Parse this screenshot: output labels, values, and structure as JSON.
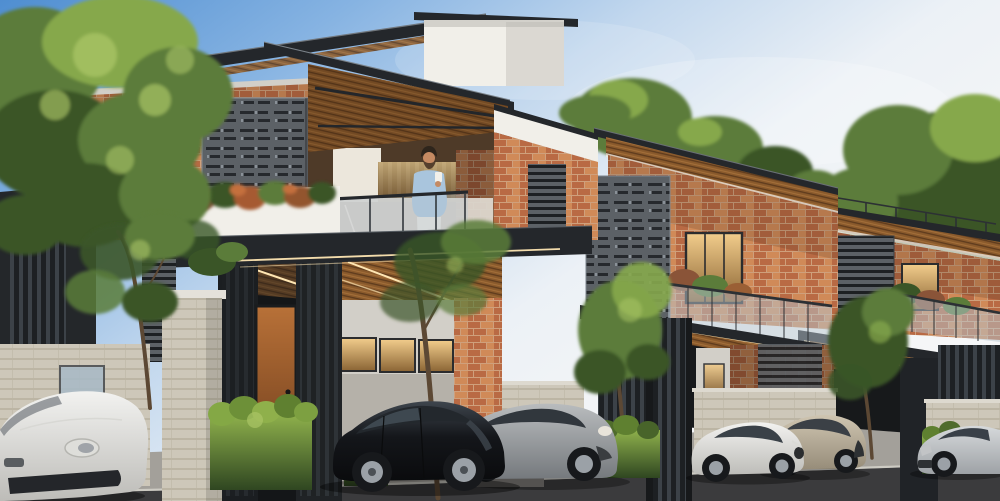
{
  "meta": {
    "title": "Modern brick row villas - daytime architectural exterior rendering",
    "image_type": "3d-architectural-render",
    "canvas": {
      "width": 1000,
      "height": 501
    }
  },
  "palette": {
    "sky1": "#4f8ed1",
    "sky2": "#86b3e2",
    "sky3": "#c3d8ee",
    "sky4": "#ecf1f6",
    "foliage_dark": "#3a5527",
    "foliage": "#5b7c3a",
    "foliage_light": "#86a84c",
    "foliage_bright": "#aac565",
    "brick": "#b96a44",
    "brick_light": "#d08a58",
    "mortar": "#cfa07c",
    "roof_dark": "#24272b",
    "steel": "#3a4147",
    "stucco": "#f1efe9",
    "stucco_shade": "#d2cfc8",
    "wood1": "#8a5a2c",
    "wood2": "#5e3b1d",
    "wood3": "#a5703a",
    "screen": "#5c6166",
    "screen_dark": "#26292d",
    "screen_light": "#8a9198",
    "slat": "#3c4248",
    "slat_dark": "#1d2023",
    "stone": "#cdc7b9",
    "stone_line": "#b0a997",
    "stone_light": "#ddd9cf",
    "glass": "#b7c6d0",
    "glass_dark": "#2f363d",
    "warm_hi": "#f2cd8c",
    "warm_lo": "#8a6434",
    "led": "#ffe6b3",
    "door_hi": "#b87138",
    "door_lo": "#6e3d1c",
    "hedge_hi": "#8fb14c",
    "hedge_lo": "#2f4621",
    "pavement": "#a3a09a",
    "road": "#3b3b3d",
    "curb": "#d2cfc8",
    "trunk": "#5c4834",
    "interior_dark": "#17191b",
    "recess": "#4e3a28",
    "car_black": "#14161a",
    "car_black_hi": "#3e454d",
    "car_gray": "#b9bcbe",
    "car_gray_lo": "#75797d",
    "car_white": "#f2f2f0",
    "car_white_lo": "#bdbcb8",
    "car_champagne": "#cfc5b1",
    "car_champagne_lo": "#968c79",
    "car_silver": "#d6d9db",
    "car_silver_lo": "#9ea2a6",
    "tire": "#17191c",
    "rim": "#9ba1a7",
    "skin": "#c58a62",
    "hair": "#2e251c",
    "shirt": "#a9c5dd",
    "pants": "#e9e7e1",
    "cup": "#f2f0ea"
  },
  "scene": {
    "sky": {
      "description": "clear blue sky, deeper blue upper-left fading to pale haze on the right"
    },
    "villas": [
      {
        "id": "villa-1",
        "position": "left foreground",
        "features": [
          "flat cantilevered roof with timber soffit",
          "white stucco tower",
          "red brick parapet",
          "perforated steel screen",
          "balcony with glass balustrade and planter flowers",
          "timber entry door",
          "slatted dark columns",
          "carport with warm clerestory windows",
          "LED cove lighting",
          "light stone pillar"
        ]
      },
      {
        "id": "villa-2",
        "position": "middle",
        "features": [
          "flat roof with timber fascia",
          "brick facade",
          "perforated screen",
          "warm-lit window",
          "glass balcony with planters",
          "carport canopy with LED strip",
          "slatted pillar",
          "beige stone compound wall"
        ]
      },
      {
        "id": "villa-3",
        "position": "right background",
        "features": [
          "flat roof with deck railing",
          "brick facade",
          "louvered screen",
          "warm-lit window",
          "glass balcony",
          "carport canopy",
          "stone compound wall"
        ]
      }
    ],
    "person": {
      "id": "man-on-balcony",
      "description": "man with dark hair and beard, light blue long-sleeve shirt, white trousers, holding a cup on the villa-1 balcony"
    },
    "cars": [
      {
        "id": "white-sports-car",
        "color_name": "white",
        "position": "far left, partially cropped, facing right"
      },
      {
        "id": "gray-sports-coupe",
        "color_name": "gray",
        "position": "in front of villa-1 brick pier"
      },
      {
        "id": "black-luxury-sedan",
        "color_name": "black",
        "position": "villa-1 carport"
      },
      {
        "id": "champagne-hatchback",
        "color_name": "champagne",
        "position": "behind white coupe at villa-2"
      },
      {
        "id": "white-coupe",
        "color_name": "white",
        "position": "villa-2 frontage, facing right"
      },
      {
        "id": "silver-sedan",
        "color_name": "silver",
        "position": "far right, partially cropped, facing left"
      }
    ],
    "vegetation": [
      "large leafy tree at left",
      "slim street tree by entry",
      "street tree by carport",
      "bushy trees fronting villa-2 and villa-3",
      "bright green hedges",
      "balcony planter flowers",
      "background tree canopies"
    ],
    "street": {
      "elements": [
        "concrete driveway apron",
        "light curb edge",
        "dark asphalt road"
      ]
    }
  }
}
